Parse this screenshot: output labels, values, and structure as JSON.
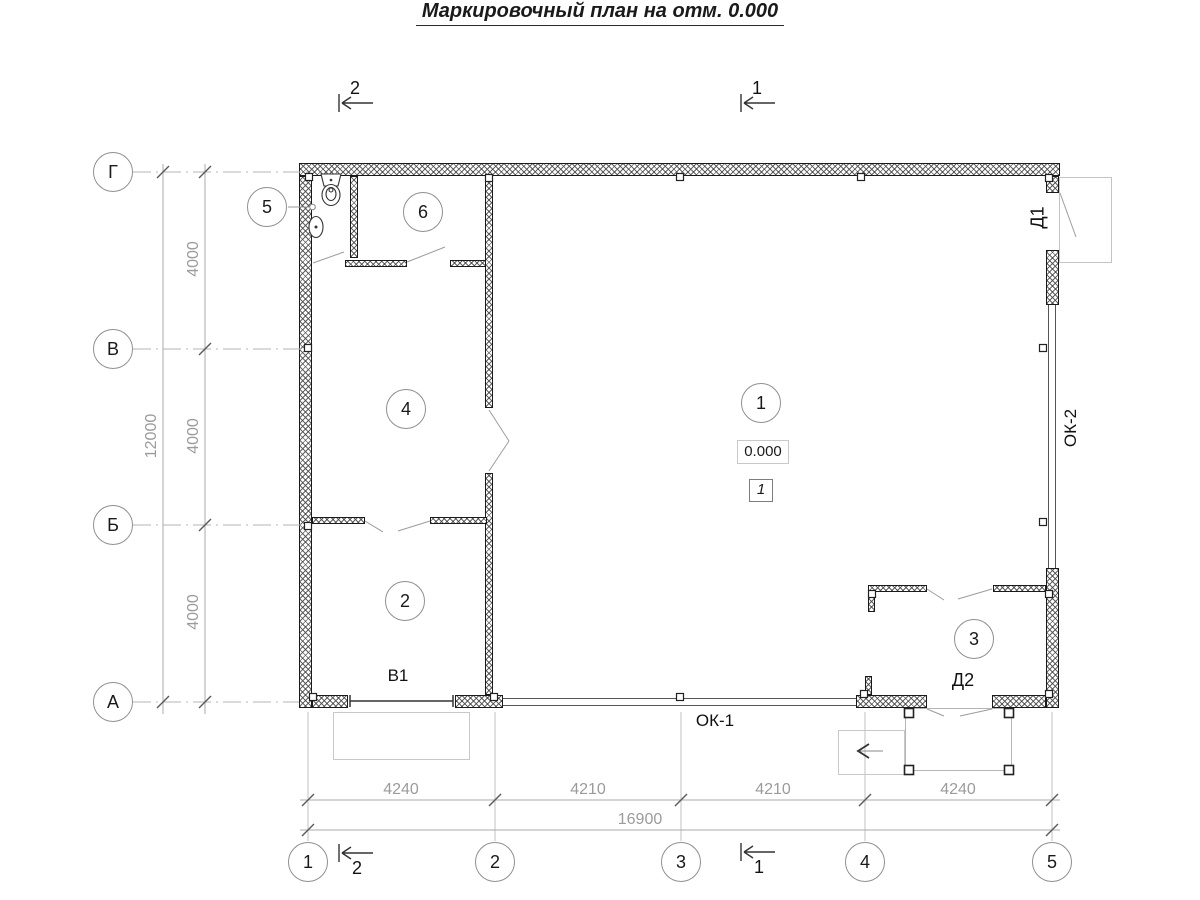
{
  "title": "Маркировочный план на отм. 0.000",
  "grid": {
    "rows": [
      {
        "label": "Г"
      },
      {
        "label": "В"
      },
      {
        "label": "Б"
      },
      {
        "label": "А"
      }
    ],
    "cols": [
      {
        "label": "1"
      },
      {
        "label": "2"
      },
      {
        "label": "3"
      },
      {
        "label": "4"
      },
      {
        "label": "5"
      }
    ]
  },
  "sections": {
    "top_left": "2",
    "top_right": "1",
    "bottom_left": "2",
    "bottom_right": "1"
  },
  "dimensions": {
    "vertical_segments": [
      "4000",
      "4000",
      "4000"
    ],
    "vertical_total": "12000",
    "horizontal_segments": [
      "4240",
      "4210",
      "4210",
      "4240"
    ],
    "horizontal_total": "16900"
  },
  "rooms": [
    {
      "number": "1"
    },
    {
      "number": "2"
    },
    {
      "number": "3"
    },
    {
      "number": "4"
    },
    {
      "number": "5"
    },
    {
      "number": "6"
    }
  ],
  "marks": {
    "elevation": "0.000",
    "zone": "1",
    "gate": "В1",
    "door_d1": "Д1",
    "door_d2": "Д2",
    "window_ok1": "ОК-1",
    "window_ok2": "ОК-2"
  },
  "colors": {
    "wall_line": "#1a1a1a",
    "dim_text": "#9b9b9b",
    "axis_line": "#b4b4b4"
  }
}
